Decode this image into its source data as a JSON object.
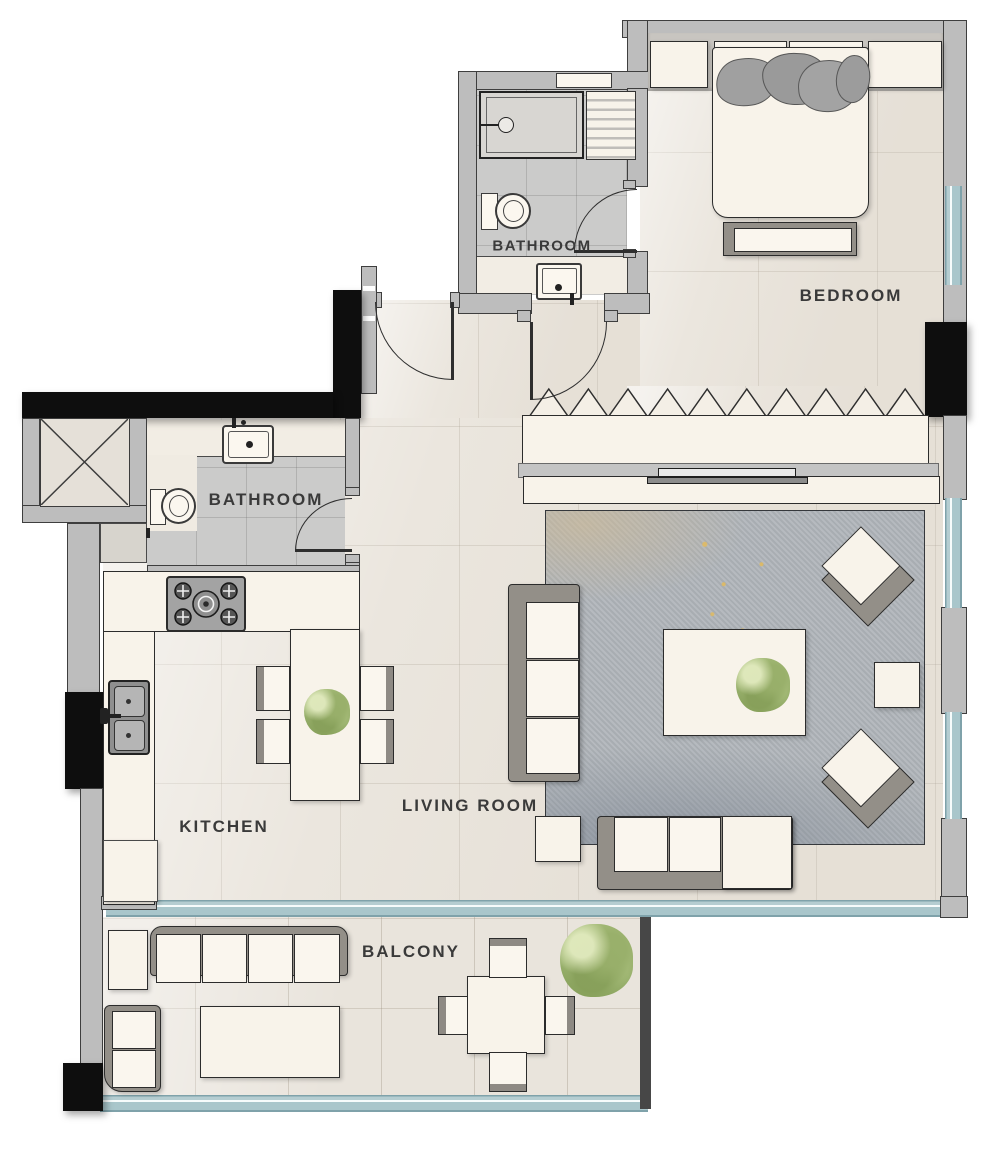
{
  "title": "Apartment Floor Plan",
  "palette": {
    "wall": "#bdbdbd",
    "wall_outline": "#3e3e3e",
    "column": "#0e0e0e",
    "window_glass": "#a9c6cb",
    "floor": "#ebe6de",
    "bathroom_tile": "#cbcbca",
    "balcony_floor": "#e9e4dc",
    "rug": "#b1b6bb",
    "rug_gold_speckle": "#e0ba60",
    "furniture": "#f8f3ea",
    "furniture_gray": "#938f88",
    "plant": "#a9bf7d",
    "label_text": "#3a3a3a"
  },
  "rooms": {
    "bedroom": {
      "label": "BEDROOM",
      "furniture": [
        "bed",
        "pillows",
        "nightstand-left",
        "nightstand-right",
        "bench",
        "wardrobe",
        "tv-console",
        "tv"
      ]
    },
    "bathroom_top": {
      "label": "BATHROOM",
      "furniture": [
        "shower",
        "shelf-unit",
        "toilet",
        "sink",
        "vanity-counter"
      ]
    },
    "bathroom_main": {
      "label": "BATHROOM",
      "furniture": [
        "toilet",
        "vanity-sink"
      ]
    },
    "kitchen": {
      "label": "KITCHEN",
      "furniture": [
        "stove",
        "double-sink",
        "counter",
        "fridge",
        "dining-table",
        "chairs",
        "plant"
      ]
    },
    "living_room": {
      "label": "LIVING ROOM",
      "furniture": [
        "l-sofa",
        "chaise",
        "coffee-table",
        "plant",
        "armchair-x2",
        "side-table-x2",
        "rug"
      ]
    },
    "balcony": {
      "label": "BALCONY",
      "furniture": [
        "outdoor-sofa",
        "lounge-chair",
        "corner-seat",
        "coffee-table",
        "dining-table",
        "chairs-x4",
        "plant"
      ]
    },
    "shaft": {
      "label": "",
      "furniture": [
        "duct-shaft"
      ]
    }
  }
}
